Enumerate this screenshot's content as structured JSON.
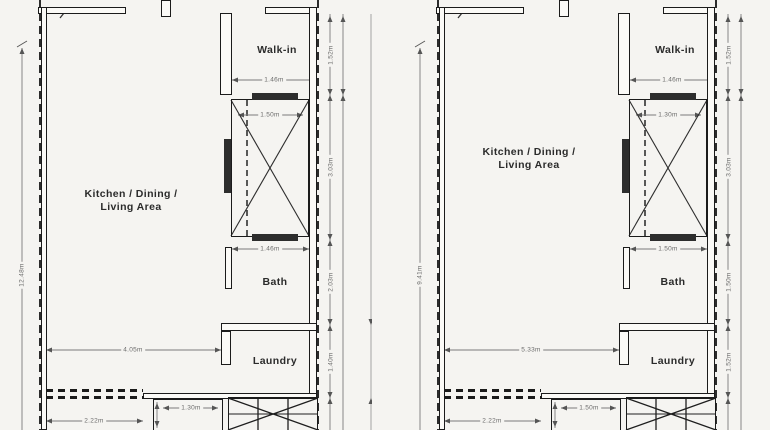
{
  "page": {
    "background": "#f5f4f1",
    "wall_color": "#1b1b1b",
    "dim_color": "#6b6b6b",
    "fill_bar_color": "#2d2d2d"
  },
  "units": [
    {
      "id": "left",
      "rooms": {
        "kitchen_line1": "Kitchen / Dining /",
        "kitchen_line2": "Living Area",
        "walkin": "Walk-in",
        "bath": "Bath",
        "laundry": "Laundry"
      },
      "dims": {
        "left_height": "12.48m",
        "living_width": "4.05m",
        "balcony_width": "2.22m",
        "walkin_width": "1.46m",
        "shaft_width": "1.50m",
        "bath_width": "1.46m",
        "small_room_width": "1.30m",
        "walkin_height": "1.52m",
        "shaft_height": "3.03m",
        "bath_height": "2.03m",
        "laundry_height": "1.40m"
      }
    },
    {
      "id": "right",
      "rooms": {
        "kitchen_line1": "Kitchen / Dining /",
        "kitchen_line2": "Living Area",
        "walkin": "Walk-in",
        "bath": "Bath",
        "laundry": "Laundry"
      },
      "dims": {
        "left_height": "9.41m",
        "living_width": "5.33m",
        "balcony_width": "2.22m",
        "walkin_width": "1.46m",
        "shaft_width": "1.30m",
        "bath_width": "1.50m",
        "small_room_width": "1.50m",
        "walkin_height": "1.52m",
        "shaft_height": "3.03m",
        "bath_height": "1.50m",
        "laundry_height": "1.52m"
      }
    }
  ]
}
